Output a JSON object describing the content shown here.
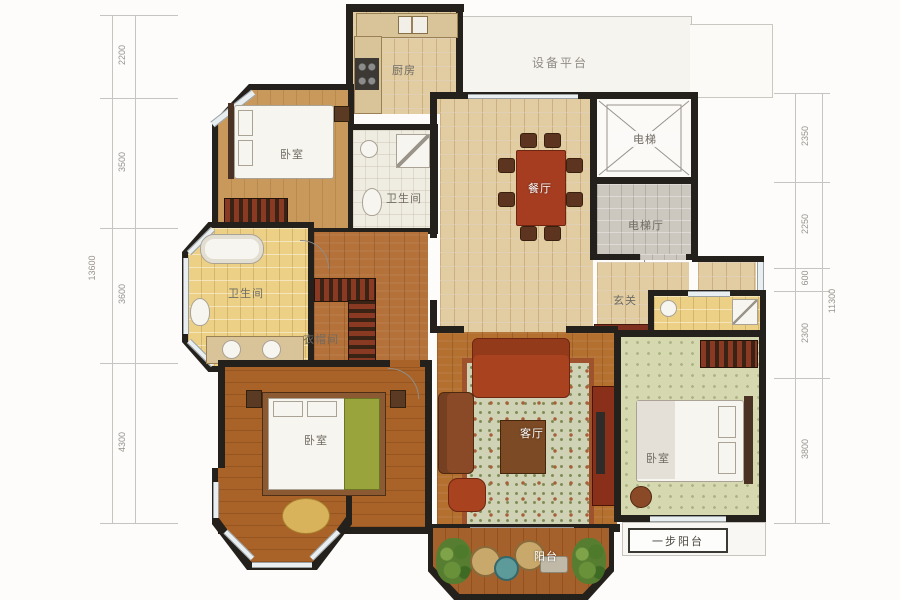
{
  "title": "residential-floor-plan",
  "labels": {
    "equipment_platform": "设备平台",
    "kitchen": "厨房",
    "bedroom_nw": "卧室",
    "bathroom_top": "卫生间",
    "dining": "餐厅",
    "elevator": "电梯",
    "elevator_hall": "电梯厅",
    "bathroom_master": "卫生间",
    "cloakroom": "衣帽间",
    "foyer": "玄关",
    "bathroom_se": "卫生间",
    "bedroom_sw": "卧室",
    "living": "客厅",
    "bedroom_se": "卧室",
    "balcony": "阳台",
    "step_balcony": "一步阳台"
  },
  "dimensions": {
    "left": {
      "total": "13600",
      "segments": [
        "2200",
        "3500",
        "3600",
        "4300"
      ]
    },
    "right": {
      "total": "11300",
      "segments": [
        "2350",
        "2250",
        "600",
        "2300",
        "3800"
      ]
    }
  },
  "colors": {
    "wall": "#24211c",
    "wood_floor": "#b4713a",
    "tile_floor": "#e2cda2",
    "bath_floor": "#ecd086",
    "accent_red": "#a63d20",
    "dim_text": "#98948f"
  }
}
